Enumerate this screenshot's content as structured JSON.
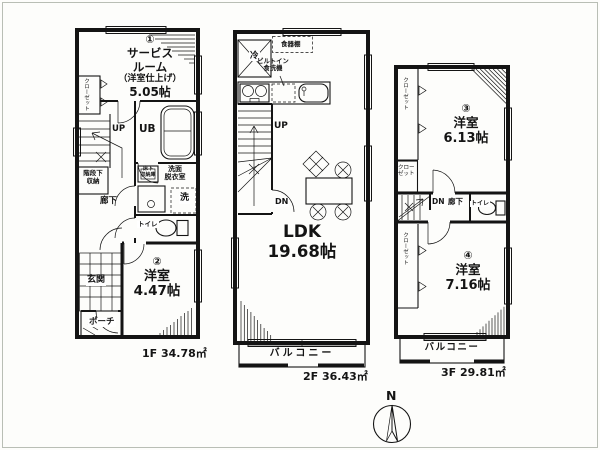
{
  "floors": {
    "f1": {
      "area_label": "1F 34.78㎡",
      "service_room": {
        "no": "①",
        "line1": "サービス",
        "line2": "ルーム",
        "line3": "（洋室仕上げ）",
        "size": "5.05帖"
      },
      "closet": "クローゼット",
      "up": "UP",
      "ub": "UB",
      "under_stair_storage": {
        "line1": "階段下",
        "line2": "収納"
      },
      "underfloor_storage": {
        "line1": "床下",
        "line2": "収納庫"
      },
      "washroom": {
        "line1": "洗面",
        "line2": "脱衣室"
      },
      "washer": "洗",
      "hallway": "廊下",
      "toilet": "トイレ",
      "room2": {
        "no": "②",
        "name": "洋室",
        "size": "4.47帖"
      },
      "entrance": "玄関",
      "porch": "ポーチ"
    },
    "f2": {
      "area_label": "2F 36.43㎡",
      "fridge": "冷",
      "cupboard": "食器棚",
      "dishwasher": {
        "line1": "ビルトイン",
        "line2": "食洗機"
      },
      "up": "UP",
      "dn": "DN",
      "ldk": {
        "name": "LDK",
        "size": "19.68帖"
      },
      "balcony": "バルコニー"
    },
    "f3": {
      "area_label": "3F 29.81㎡",
      "room3": {
        "no": "③",
        "name": "洋室",
        "size": "6.13帖"
      },
      "closet_top": "クローゼット",
      "closet_mid": "クローゼット",
      "closet_low": "クローゼット",
      "dn": "DN",
      "hallway": "廊下",
      "toilet": "トイレ",
      "room4": {
        "no": "④",
        "name": "洋室",
        "size": "7.16帖"
      },
      "balcony": "バルコニー"
    }
  },
  "compass": {
    "label": "N"
  }
}
